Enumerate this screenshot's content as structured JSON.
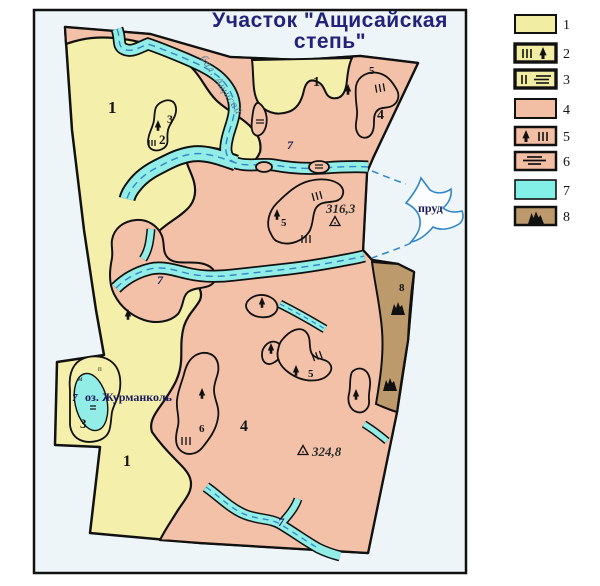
{
  "title": {
    "line1": "Участок \"Ащисайская",
    "line2": "степь\""
  },
  "legend": {
    "items": [
      {
        "label": "1",
        "symbols": []
      },
      {
        "label": "2",
        "symbols": [
          "bars-III",
          "tree"
        ]
      },
      {
        "label": "3",
        "symbols": [
          "bars-II",
          "hatch-lines"
        ]
      },
      {
        "label": "4",
        "symbols": []
      },
      {
        "label": "5",
        "symbols": [
          "tree",
          "bars-III"
        ]
      },
      {
        "label": "6",
        "symbols": [
          "hatch-lines"
        ]
      },
      {
        "label": "7",
        "symbols": []
      },
      {
        "label": "8",
        "symbols": [
          "mountain"
        ]
      }
    ]
  },
  "map": {
    "region_labels": {
      "r1a": "1",
      "r1b": "1",
      "r1c": "1",
      "r2": "2",
      "r3a": "3",
      "r3b": "3",
      "r4a": "4",
      "r4b": "4",
      "r5a": "5",
      "r5b": "5",
      "r5c": "5",
      "r6": "6",
      "r8": "8"
    },
    "water_labels": {
      "stream_name": "бал. Ащисай",
      "pond": "пруд",
      "lake_name": "оз. Журманколь",
      "w7a": "7",
      "w7b": "7",
      "w7c": "7",
      "w7d": "7"
    },
    "elevations": {
      "e1": "316,3",
      "e2": "324,8"
    },
    "marks": {
      "p": "п",
      "m": "м"
    }
  },
  "colors": {
    "yellow": "#f4f0ab",
    "pink": "#f2c1a8",
    "cyan": "#92ede6",
    "brown": "#bd9a6c",
    "frame_background": "#edf5f8",
    "outline": "#111111",
    "title_text": "#22227a",
    "water_label_text": "#1a1a5e",
    "dashed_water_line": "#2f86c8",
    "stream_label_text": "#647f94"
  }
}
